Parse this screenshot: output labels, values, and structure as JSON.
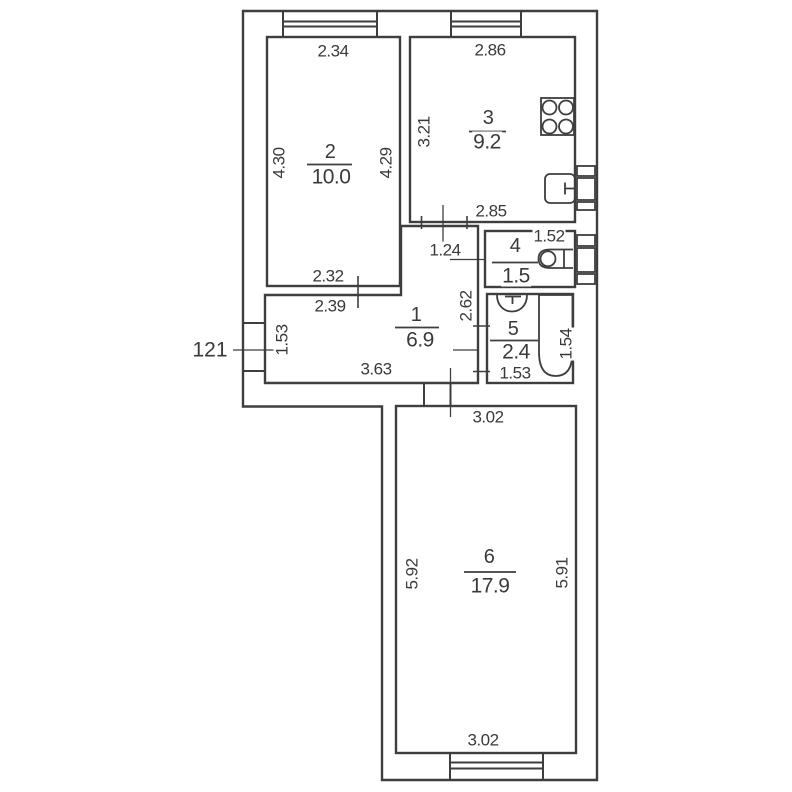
{
  "apartment": {
    "number": "121"
  },
  "rooms": {
    "r1": {
      "number": "1",
      "area": "6.9"
    },
    "r2": {
      "number": "2",
      "area": "10.0"
    },
    "r3": {
      "number": "3",
      "area": "9.2"
    },
    "r4": {
      "number": "4",
      "area": "1.5"
    },
    "r5": {
      "number": "5",
      "area": "2.4"
    },
    "r6": {
      "number": "6",
      "area": "17.9"
    }
  },
  "dimensions": {
    "room2_top": "2.34",
    "room2_left": "4.30",
    "room2_right": "4.29",
    "room2_bottom": "2.32",
    "room3_top": "2.86",
    "room3_left": "3.21",
    "room3_bottom": "2.85",
    "hall_top": "2.39",
    "hall_nook_width": "1.24",
    "hall_left": "1.53",
    "hall_bottom": "3.63",
    "hall_right": "2.62",
    "wc_top": "1.52",
    "bath_right": "1.54",
    "bath_bottom": "1.53",
    "room6_top": "3.02",
    "room6_left": "5.92",
    "room6_right": "5.91",
    "room6_bottom": "3.02"
  },
  "colors": {
    "line": "#3e3e3e",
    "background": "#ffffff"
  }
}
